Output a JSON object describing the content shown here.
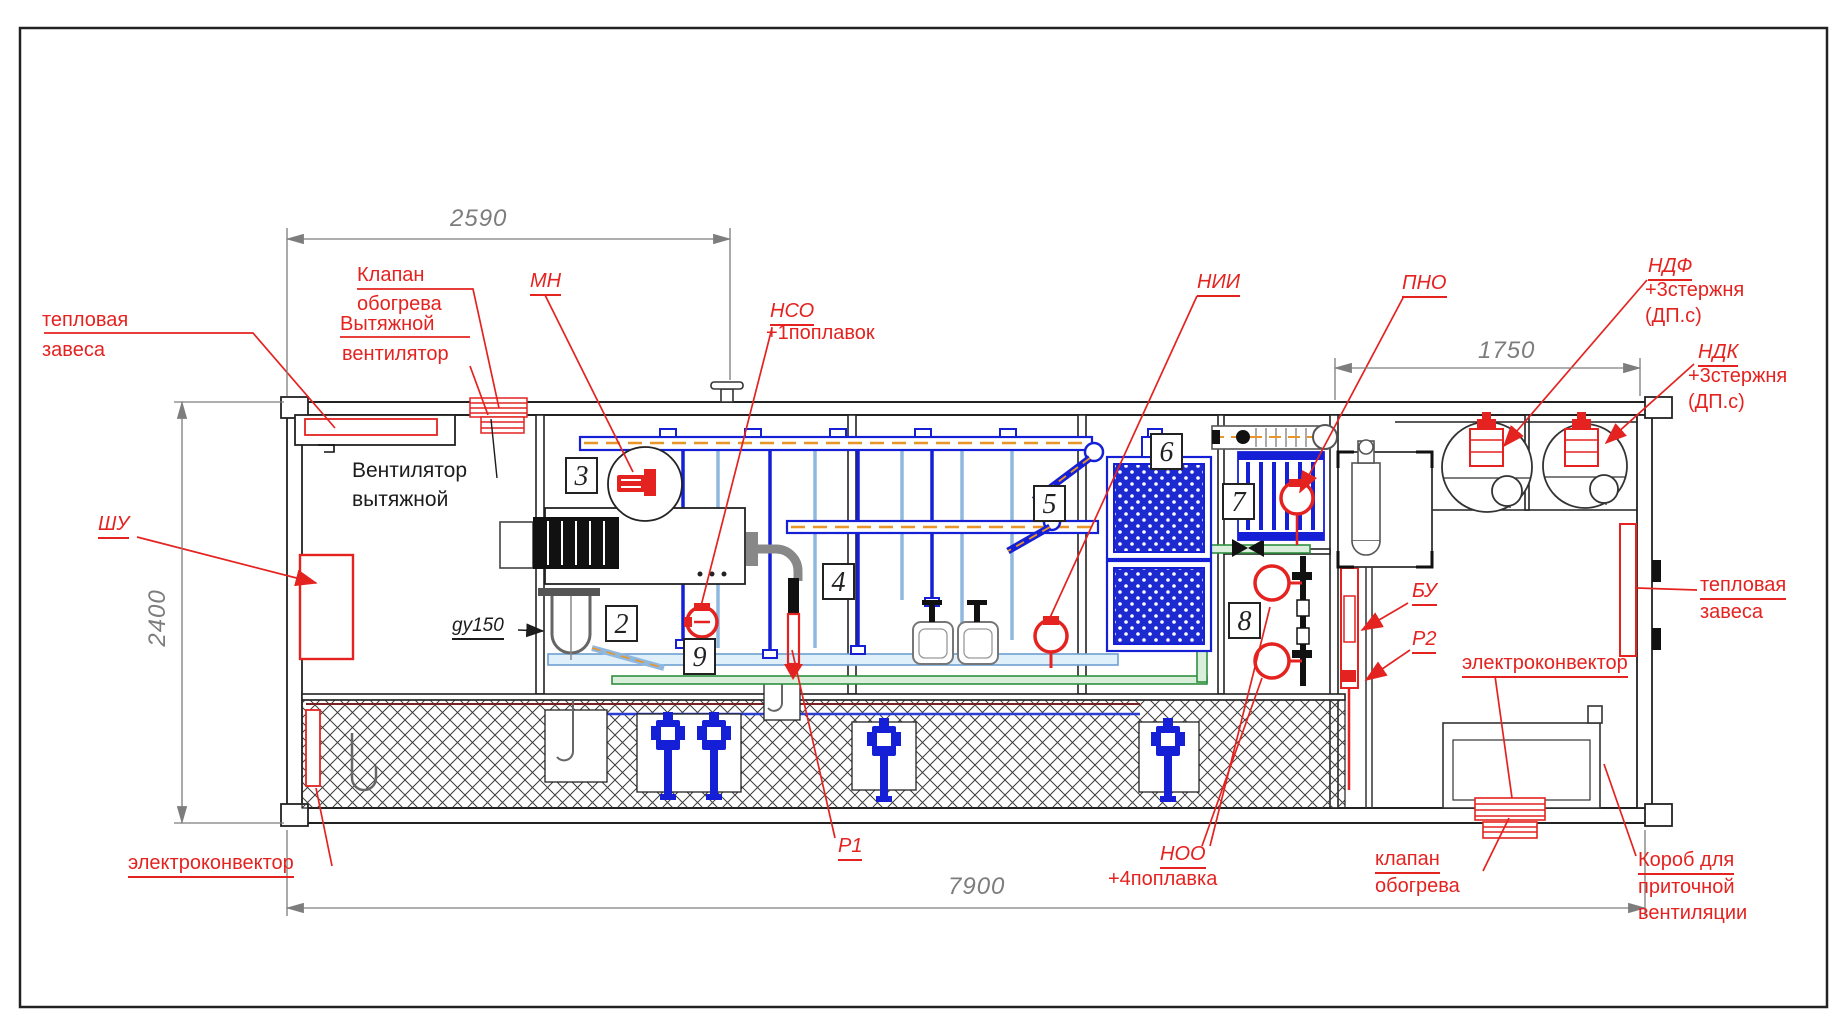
{
  "dimensions": {
    "top_left_span": "2590",
    "top_right_span": "1750",
    "height": "2400",
    "total_length": "7900"
  },
  "labels": {
    "heat_curtain_left_1": "тепловая",
    "heat_curtain_left_2": "завеса",
    "heating_valve_top_1": "Клапан",
    "heating_valve_top_2": "обогрева",
    "exhaust_fan_red_1": "Вытяжной",
    "exhaust_fan_red_2": "вентилятор",
    "exhaust_fan_black_1": "Вентилятор",
    "exhaust_fan_black_2": "вытяжной",
    "mn": "МН",
    "nso": "НСО",
    "nso_note": "+1поплавок",
    "nii": "НИИ",
    "pno": "ПНО",
    "ndf": "НДФ",
    "ndf_note1": "+3стержня",
    "ndf_note2": "(ДП.с)",
    "ndk": "НДК",
    "ndk_note1": "+3стержня",
    "ndk_note2": "(ДП.с)",
    "shu": "ШУ",
    "gy150": "gy150",
    "bu": "БУ",
    "p2": "Р2",
    "p1": "Р1",
    "noo": "НОО",
    "noo_note": "+4поплавка",
    "heat_curtain_right_1": "тепловая",
    "heat_curtain_right_2": "завеса",
    "convector_right": "электроконвектор",
    "convector_left": "электроконвектор",
    "floor_valve_1": "клапан",
    "floor_valve_2": "обогрева",
    "duct_1": "Короб для",
    "duct_2": "приточной",
    "duct_3": "вентиляции"
  },
  "sections": {
    "n2": "2",
    "n3": "3",
    "n4": "4",
    "n5": "5",
    "n6": "6",
    "n7": "7",
    "n8": "8",
    "n9": "9"
  },
  "colors": {
    "annotation_red": "#e42320",
    "pipe_blue": "#1520d6",
    "pipe_light_blue": "#8fb8e0",
    "pipe_green": "#2f8f3f",
    "trace_orange": "#e8952a",
    "dimension_gray": "#7d7d7d",
    "line_black": "#1c1c1c"
  }
}
